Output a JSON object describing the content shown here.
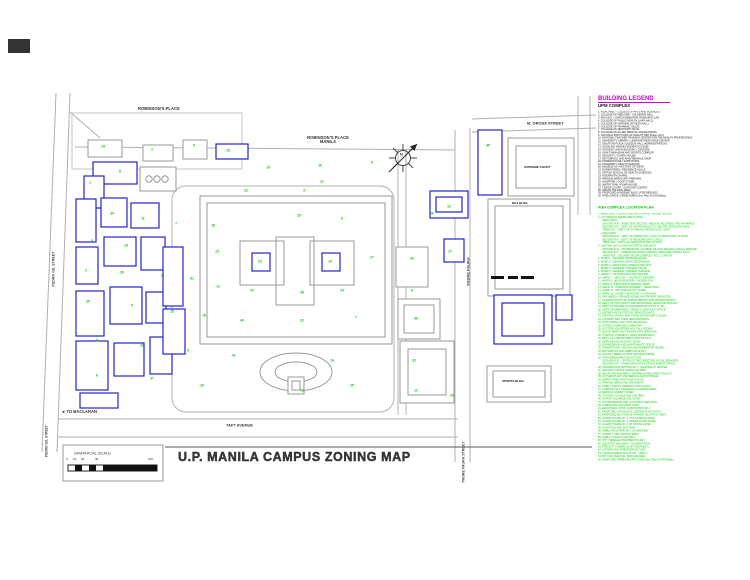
{
  "title_block": {
    "title": "U.P. MANILA CAMPUS ZONING MAP"
  },
  "scale": {
    "label": "GRAPHICAL SCALE",
    "ticks": [
      {
        "t": "0",
        "x": 66
      },
      {
        "t": "10",
        "x": 73
      },
      {
        "t": "20",
        "x": 81
      },
      {
        "t": "40",
        "x": 95
      },
      {
        "t": "100",
        "x": 148
      }
    ]
  },
  "compass": {
    "letter": "N"
  },
  "streets": {
    "taft": "TAFT AVENUE",
    "to_baclaran": "TO BACLARAN",
    "west_arrow": "◄",
    "m_orosa": "M. OROSA STREET",
    "padre_faura": "PADRE FAURA",
    "padre_faura_street": "PADRE FAURA STREET",
    "pedro_gil": "PEDRO GIL STREET",
    "pedro_gil_corner": "PEDRO GIL STREET"
  },
  "places": {
    "robinsons": "ROBINSON'S PLACE",
    "robinsons_manila_line1": "ROBINSON'S PLACE",
    "robinsons_manila_line2": "MANILA",
    "supreme_court": "SUPREME COURT",
    "doj": "DOJ BLDG.",
    "sports": "SPORTS BLDG."
  },
  "legend": {
    "title": "BUILDING LEGEND",
    "upm_heading": "UPM COMPLEX",
    "upm_items": [
      "1. RIZAL HALL - COLLEGE OF ARTS AND SCIENCES",
      "2. COLLEGE OF MEDICINE - CALDERON HALL",
      "3. PAULINO J. GARCIA MEMORIAL RESEARCH LAB.",
      "4. COLLEGE OF PUBLIC HEALTH (LARA HALL)",
      "5. COLLEGE OF NURSING (SOTEJO HALL)",
      "6. COLLEGE OF PHARMACY BLDG.",
      "7. COLLEGE OF DENTISTRY BLDG.",
      "8. COLLEGE OF ALLIED MEDICAL PROFESSIONS",
      "9. NATIONAL INSTITUTES OF HEALTH (NIH Phase-I & II)",
      "10. NATIONAL TEACHER TRAINING CENTER FOR THE HEALTH PROFESSIONS",
      "11. UNIVERSITY LIBRARY / LEARNING RESOURCE CENTER",
      "12. OBLATION PLAZA / QUEZON HALL (ADMINISTRATION)",
      "13. GUSALING ANDRES BONIFACIO (GAB)",
      "14. STUDENT UNION BUILDING / CANTEEN",
      "15. UPM GYMNASIUM AND SPORTS COMPLEX",
      "16. SECURITY / GUARD HOUSE",
      "17. MOTORPOOL AND MAINTENANCE SHOP",
      "18. POWER HOUSE / SUBSTATION",
      "19. UNIVERSITY HEALTH SERVICE",
      "20. MUSEUM OF A HISTORY OF IDEAS",
      "21. DORMITORIES / RESIDENCE HALLS",
      "22. UP-PGH SCHOOL OF HEALTH SCIENCES",
      "23. INTERFAITH CHAPEL",
      "24. PARKING AREAS (PAY PARKING)",
      "25. SHOPPING / COOP STORE",
      "26. WATER TANK / PUMP HOUSE",
      "27. TENNIS COURT / OUTDOOR COURTS",
      "28. WASTE HOLDING AREA",
      "29. PROPOSED ACADEMIC BLDG. (FOR BIDDING)",
      "30. OPEN SPACE / GREEN AREA (Ord. Plan-03 PGH Bldg.)"
    ],
    "pgh_heading": "PGH COMPLEX LOCATOR PLAN",
    "pgh_items": [
      "1. EMERGENCY ROOM COMPLEX (TRIAGE, TRAUMA, ER-OR)",
      "2. OUT-PATIENT DEPARTMENT (OPD)",
      "WEST WING :",
      "GROUND FLR. : ADMITTING SECTION, MEDICAL RECORDS, OPD PHARMACY",
      "SECOND FLR. : DEPT. OF OPHTHALMOLOGY, SENTRO OFTALMOLOHIKO",
      "THIRD FLR. : DEPT. OF OTORHINOLARYNGOLOGY (ENT)",
      "EAST WING :",
      "GROUND FLR. : DEPT. OF RADIOLOGY, X-RAY, ULTRASOUND, CT-SCAN",
      "SECOND FLR. : DEPT. OF MEDICINE OPD CLINICS",
      "THIRD FLR. : DEPT. OF PEDIATRICS OPD CLINICS",
      "3. CENTRAL BLOCK (MAIN HOSPITAL BUILDING)",
      "GROUND FLR. : INFORMATION, CASHIER, BILLING, MEDICAL SOCIAL SERVICE",
      "SECOND FLR. : OPERATING ROOM COMPLEX, RECOVERY ROOM, PACU",
      "THIRD FLR. : DELIVERY ROOM COMPLEX, NICU, LYING-IN",
      "4. WARD 1 : GENERAL MEDICINE (MALE)",
      "5. WARD 2 : GENERAL MEDICINE (FEMALE)",
      "6. WARD 3 : INFECTIOUS DISEASE SECTION",
      "7. WARD 4 : GENERAL SURGERY (MALE)",
      "8. WARD 5 : GENERAL SURGERY (FEMALE)",
      "9. WARD 6 : ORTHOPEDICS AND TRAUMA",
      "10. WARD 7 : UROLOGY / THORACIC SURGERY",
      "11. WARD 8 : NEUROSURGERY / NEUROLOGY",
      "12. WARD 9 : PEDIATRICS GENERAL WARD",
      "13. WARD 10 : PEDIATRIC SURGERY / HEMA-ONCO",
      "14. WARD 11 : OB-GYNECOLOGY WARD",
      "15. WARD 12 : CHARITY MATERNITY / HIGH RISK",
      "16. PAY WARDS / PRIVATE ROOMS (PAY PATIENT SERVICES)",
      "17. CANCER INSTITUTE (RADIOTHERAPY AND CHEMOTHERAPY)",
      "18. DEPT. OF PSYCHIATRY AND BEHAVIORAL MEDICINE PAVILION",
      "19. DEPT. OF REHABILITATION MEDICINE (PT-OT GYM)",
      "20. DEPT. OF EMERGENCY MEDICAL SERVICES OFFICE",
      "21. DIETARY AND NUTRITION SERVICES BLDG.",
      "22. CENTRAL SUPPLY AND STERILIZATION DEPT. (CSSD)",
      "23. LAUNDRY AND LINEN SERVICES BLDG.",
      "24. PGH CHAPEL (STO. NINO DE PRAGA)",
      "25. NURSES HOME AND DORMITORY",
      "26. DOCTORS QUARTERS AND CALL ROOMS",
      "27. BLOOD BANK AND TRANSFUSION SERVICES",
      "28. HOSPITAL PHARMACY (MAIN DISPENSARY)",
      "29. DEPT. OF LABORATORIES (PATHOLOGY)",
      "30. MORGUE AND AUTOPSY ROOM",
      "31. ENGINEERING AND MAINTENANCE OFFICE",
      "32. POWER PLANT / BOILER AND GENERATOR HOUSE",
      "33. MOTORPOOL AND AMBULANCE BAY",
      "34. FACULTY MEDICAL ARTS BUILDING (FMAB)",
      "35. PGH ADMINISTRATION OFFICES",
      "GROUND FLR. : OFFICE OF THE DIRECTOR, FISCAL SERVICES",
      "SECOND FLR. : HUMAN RESOURCE DEVELOPMENT OFFICE",
      "36. INFORMATION TECHNOLOGY / TELEHEALTH CENTER",
      "37. SECURITY FORCE HEADQUARTERS",
      "38. WASTE MANAGEMENT / MATERIALS RECOVERY FACILITY",
      "39. OXYGEN PLANT AND MEDICAL GAS STORAGE",
      "40. WATER TANKS AND PUMP HOUSE",
      "41. PARKING AREAS AND DRIVEWAYS",
      "42. OPEN COURTS, GARDENS AND PLAZAS",
      "43. SCIENCE HALL / RESEARCH LABORATORIES",
      "44. MEDICAL LIBRARY ANNEX",
      "45. STUDENT LOUNGE AND CANTEEN",
      "46. UP-PGH TELEMEDICINE / NTHC",
      "47. HOUSEKEEPING AND JANITORIAL SERVICES",
      "48. CARPENTRY AND PAINT SHOP",
      "49. ELECTRICAL SHOP / SUBSTATION NO. 2",
      "50. PROPOSED DIAGNOSTIC CENTER (FOR CONST.)",
      "51. PROPOSED MULTI-DECK PARKING (DOH-PGH JOINT)",
      "52. GUARD HOUSE NO. 1 (TAFT AVENUE GATE)",
      "53. GUARD HOUSE NO. 2 (PADRE FAURA GATE)",
      "54. GUARD HOUSE NO. 3 (M. OROSA GATE)",
      "55. FLAG POLE AND ROTUNDA",
      "56. AMBULANCE PARKING / LOADING BAY",
      "57. CHARITY OPD WAITING SHED",
      "58. PUBLIC TOILETS AND BATH",
      "59. STP / SEWAGE TREATMENT PLANT",
      "60. ELEVATED WALKWAY / COVERED PATH",
      "61. FIRE EXIT TOWERS (EAST AND WEST)",
      "62. CISTERN AND FIRE RESERVE TANK",
      "63. TRANSFORMER VAULTS NO. 1 AND 2",
      "64. BICYCLE PARKING / PEDICAB AREA",
      "65. PROPOSED GREEN BUFFER ZONE (Ord. Plan-02 PGH Bldg.)"
    ]
  },
  "map": {
    "markers": [
      {
        "n": "14",
        "x": 103,
        "y": 147
      },
      {
        "n": "2",
        "x": 152,
        "y": 150
      },
      {
        "n": "9",
        "x": 194,
        "y": 146
      },
      {
        "n": "16",
        "x": 228,
        "y": 151
      },
      {
        "n": "21",
        "x": 322,
        "y": 182
      },
      {
        "n": "5",
        "x": 372,
        "y": 163
      },
      {
        "n": "1",
        "x": 90,
        "y": 183
      },
      {
        "n": "8",
        "x": 120,
        "y": 172
      },
      {
        "n": "22",
        "x": 246,
        "y": 191
      },
      {
        "n": "3",
        "x": 304,
        "y": 191
      },
      {
        "n": "34",
        "x": 112,
        "y": 214
      },
      {
        "n": "11",
        "x": 143,
        "y": 219
      },
      {
        "n": "7",
        "x": 176,
        "y": 224
      },
      {
        "n": "18",
        "x": 213,
        "y": 226
      },
      {
        "n": "25",
        "x": 299,
        "y": 216
      },
      {
        "n": "6",
        "x": 342,
        "y": 219
      },
      {
        "n": "30",
        "x": 432,
        "y": 214
      },
      {
        "n": "12",
        "x": 449,
        "y": 207
      },
      {
        "n": "4",
        "x": 92,
        "y": 241
      },
      {
        "n": "19",
        "x": 126,
        "y": 246
      },
      {
        "n": "15",
        "x": 217,
        "y": 252
      },
      {
        "n": "23",
        "x": 260,
        "y": 262
      },
      {
        "n": "10",
        "x": 330,
        "y": 262
      },
      {
        "n": "27",
        "x": 372,
        "y": 258
      },
      {
        "n": "33",
        "x": 412,
        "y": 259
      },
      {
        "n": "17",
        "x": 450,
        "y": 252
      },
      {
        "n": "2",
        "x": 86,
        "y": 271
      },
      {
        "n": "26",
        "x": 122,
        "y": 273
      },
      {
        "n": "9",
        "x": 162,
        "y": 276
      },
      {
        "n": "31",
        "x": 192,
        "y": 279
      },
      {
        "n": "13",
        "x": 218,
        "y": 287
      },
      {
        "n": "20",
        "x": 252,
        "y": 291
      },
      {
        "n": "38",
        "x": 302,
        "y": 293
      },
      {
        "n": "24",
        "x": 342,
        "y": 291
      },
      {
        "n": "8",
        "x": 412,
        "y": 291
      },
      {
        "n": "35",
        "x": 88,
        "y": 302
      },
      {
        "n": "5",
        "x": 132,
        "y": 306
      },
      {
        "n": "28",
        "x": 172,
        "y": 312
      },
      {
        "n": "16",
        "x": 204,
        "y": 316
      },
      {
        "n": "40",
        "x": 242,
        "y": 321
      },
      {
        "n": "22",
        "x": 302,
        "y": 321
      },
      {
        "n": "7",
        "x": 356,
        "y": 318
      },
      {
        "n": "36",
        "x": 416,
        "y": 319
      },
      {
        "n": "11",
        "x": 97,
        "y": 341
      },
      {
        "n": "29",
        "x": 142,
        "y": 346
      },
      {
        "n": "3",
        "x": 188,
        "y": 351
      },
      {
        "n": "41",
        "x": 234,
        "y": 356
      },
      {
        "n": "14",
        "x": 332,
        "y": 361
      },
      {
        "n": "32",
        "x": 414,
        "y": 361
      },
      {
        "n": "6",
        "x": 97,
        "y": 376
      },
      {
        "n": "37",
        "x": 152,
        "y": 379
      },
      {
        "n": "19",
        "x": 202,
        "y": 386
      },
      {
        "n": "43",
        "x": 302,
        "y": 391
      },
      {
        "n": "25",
        "x": 352,
        "y": 386
      },
      {
        "n": "12",
        "x": 416,
        "y": 391
      },
      {
        "n": "39",
        "x": 452,
        "y": 396
      },
      {
        "n": "45",
        "x": 488,
        "y": 146
      },
      {
        "n": "10",
        "x": 268,
        "y": 168
      },
      {
        "n": "20",
        "x": 320,
        "y": 166
      }
    ]
  }
}
